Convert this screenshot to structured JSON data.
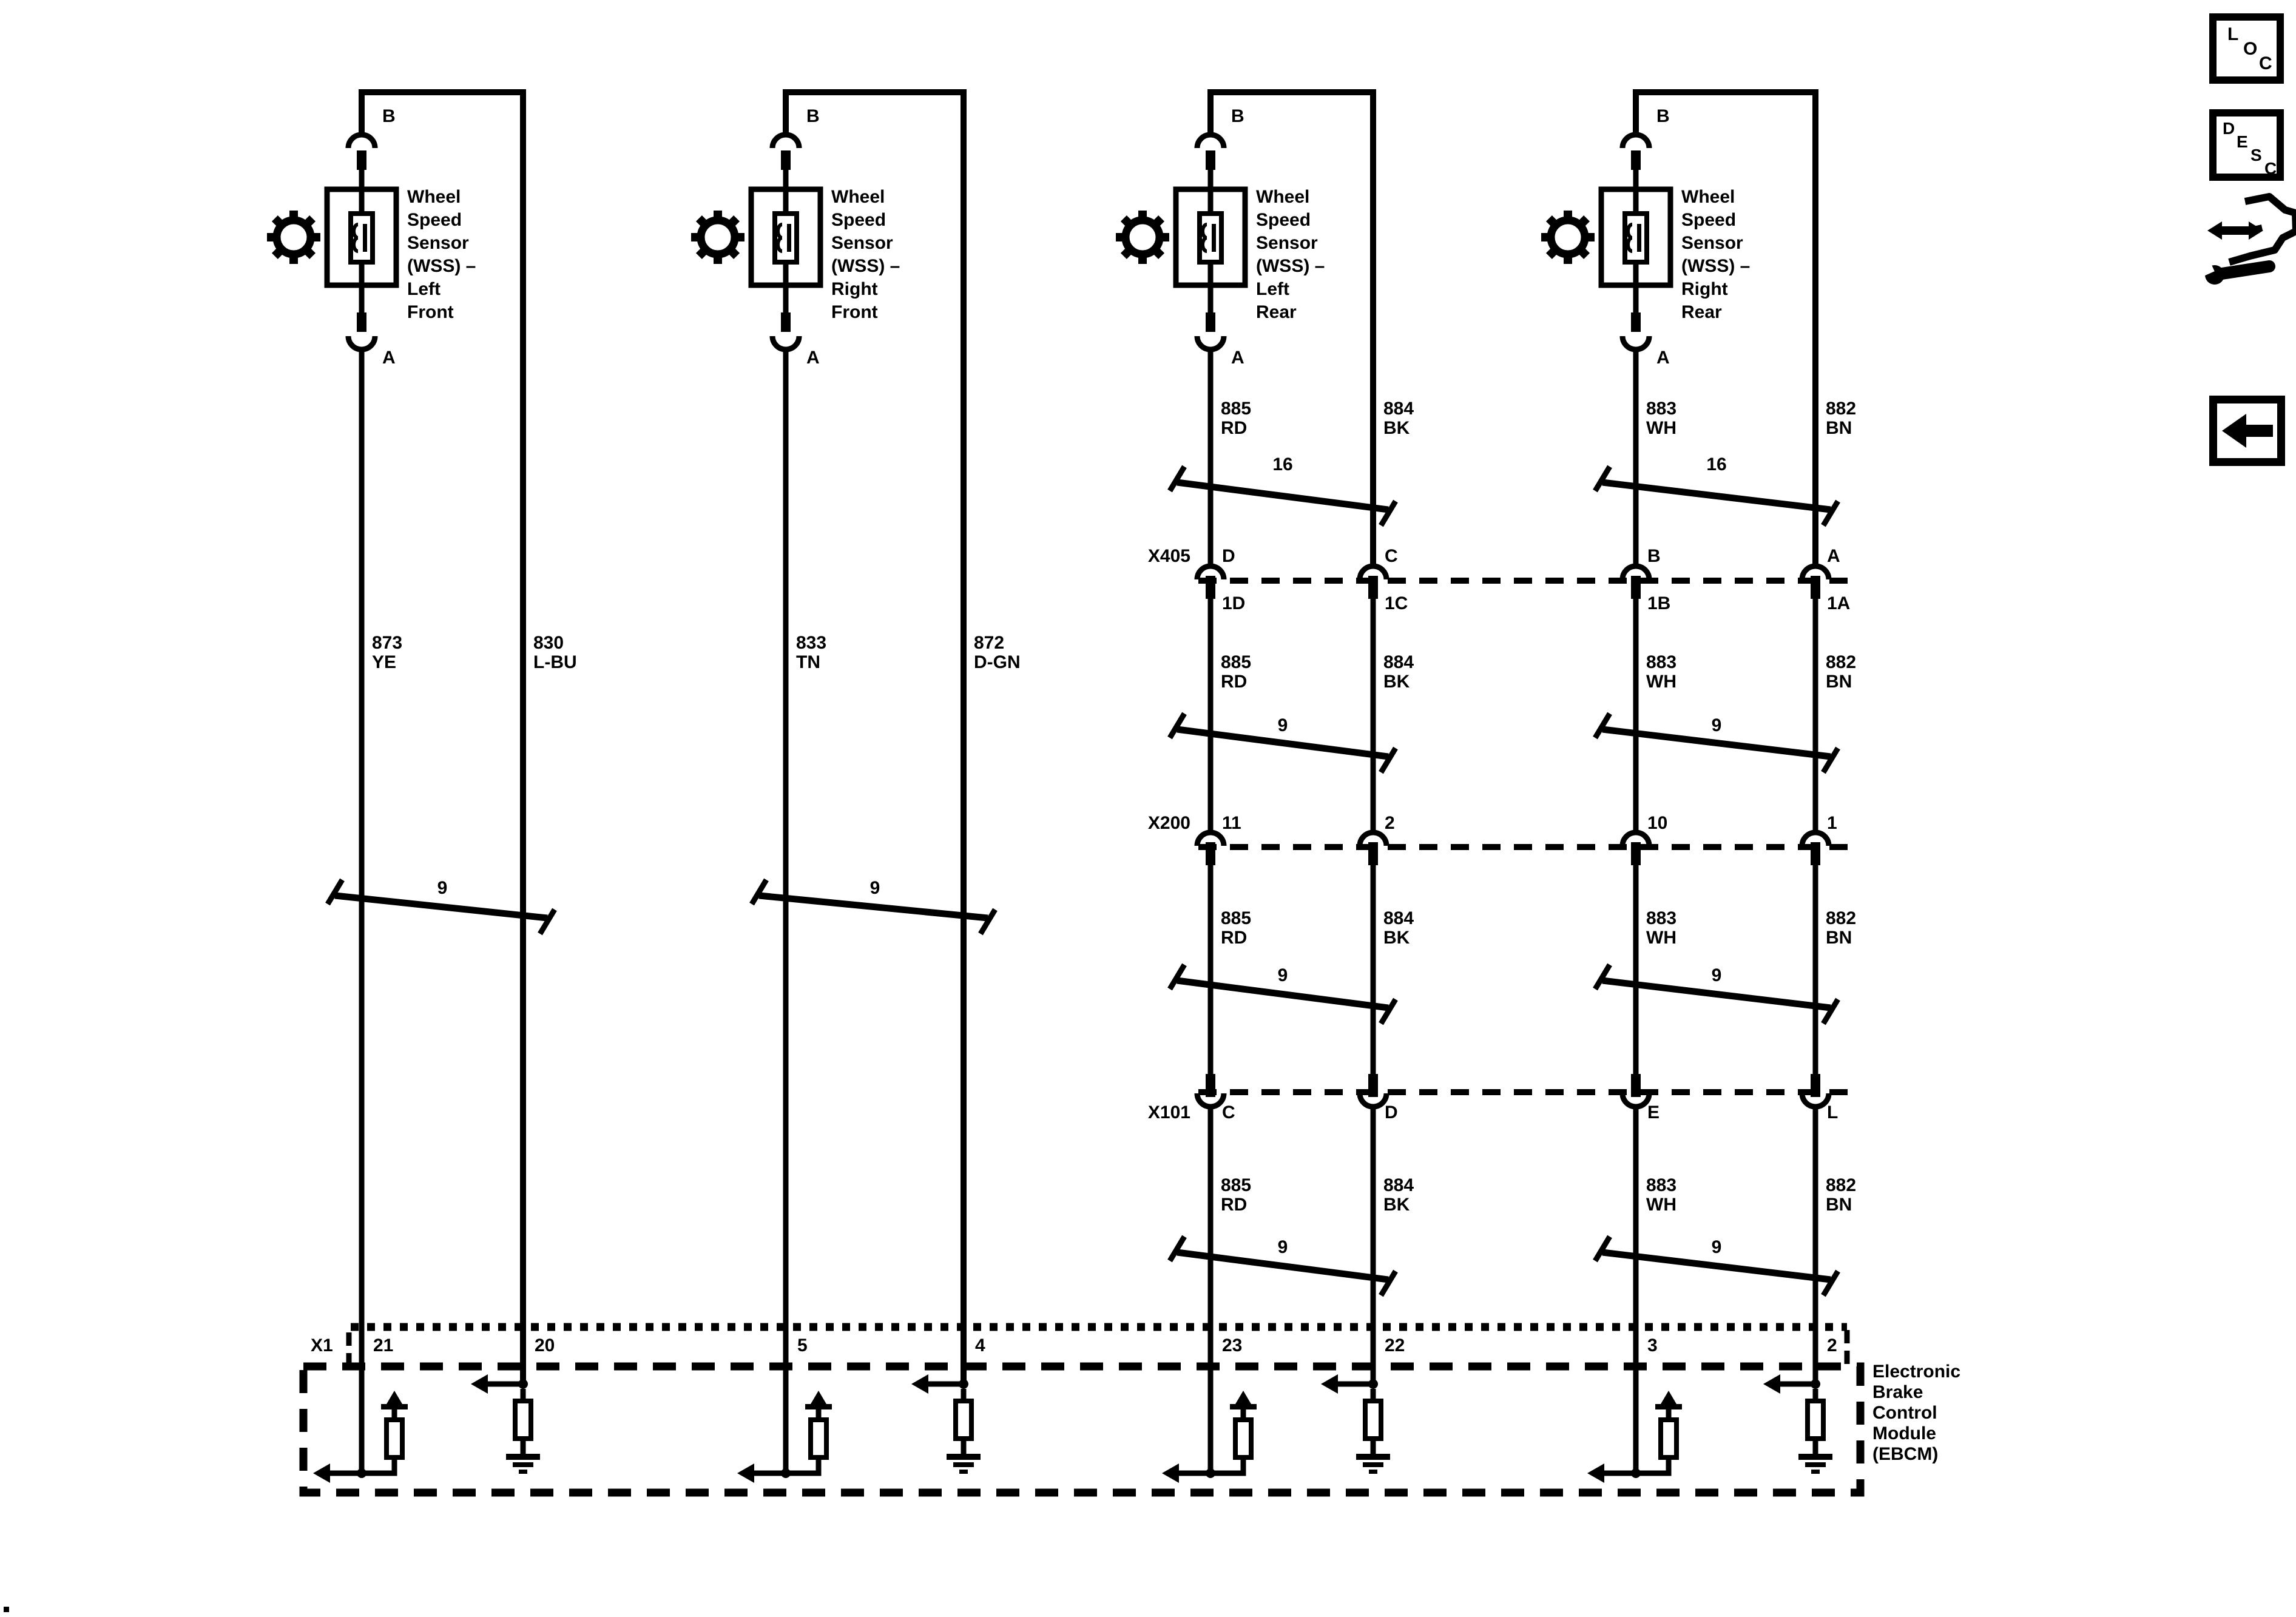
{
  "sensors": [
    {
      "label": "Wheel\nSpeed\nSensor\n(WSS) –\nLeft\nFront",
      "terminal_top": "B",
      "terminal_bottom": "A"
    },
    {
      "label": "Wheel\nSpeed\nSensor\n(WSS) –\nRight\nFront",
      "terminal_top": "B",
      "terminal_bottom": "A"
    },
    {
      "label": "Wheel\nSpeed\nSensor\n(WSS) –\nLeft\nRear",
      "terminal_top": "B",
      "terminal_bottom": "A"
    },
    {
      "label": "Wheel\nSpeed\nSensor\n(WSS) –\nRight\nRear",
      "terminal_top": "B",
      "terminal_bottom": "A"
    }
  ],
  "wire_labels": {
    "front": [
      "873\nYE",
      "830\nL-BU",
      "833\nTN",
      "872\nD-GN"
    ],
    "rear1": [
      "885\nRD",
      "884\nBK",
      "883\nWH",
      "882\nBN"
    ],
    "rear2": [
      "885\nRD",
      "884\nBK",
      "883\nWH",
      "882\nBN"
    ],
    "rear3": [
      "885\nRD",
      "884\nBK",
      "883\nWH",
      "882\nBN"
    ],
    "rear4": [
      "885\nRD",
      "884\nBK",
      "883\nWH",
      "882\nBN"
    ]
  },
  "twists": {
    "seg1": [
      "16",
      "16"
    ],
    "seg2": [
      "9",
      "9"
    ],
    "seg3": [
      "9",
      "9"
    ],
    "seg4": [
      "9",
      "9"
    ],
    "front": [
      "9",
      "9"
    ]
  },
  "connectors": {
    "x405": {
      "name": "X405",
      "pins_top": [
        "D",
        "C",
        "B",
        "A"
      ],
      "pins_bottom": [
        "1D",
        "1C",
        "1B",
        "1A"
      ]
    },
    "x200": {
      "name": "X200",
      "pins": [
        "11",
        "2",
        "10",
        "1"
      ]
    },
    "x101": {
      "name": "X101",
      "pins": [
        "C",
        "D",
        "E",
        "L"
      ]
    },
    "x1": {
      "name": "X1",
      "pins": [
        "21",
        "20",
        "5",
        "4",
        "23",
        "22",
        "3",
        "2"
      ]
    }
  },
  "ebcm": {
    "label": "Electronic\nBrake\nControl\nModule\n(EBCM)"
  },
  "icons": {
    "loc": [
      "L",
      "O",
      "C"
    ],
    "desc": [
      "D",
      "E",
      "S",
      "C"
    ]
  },
  "colors": {
    "ink": "#000000",
    "paper": "#ffffff"
  }
}
